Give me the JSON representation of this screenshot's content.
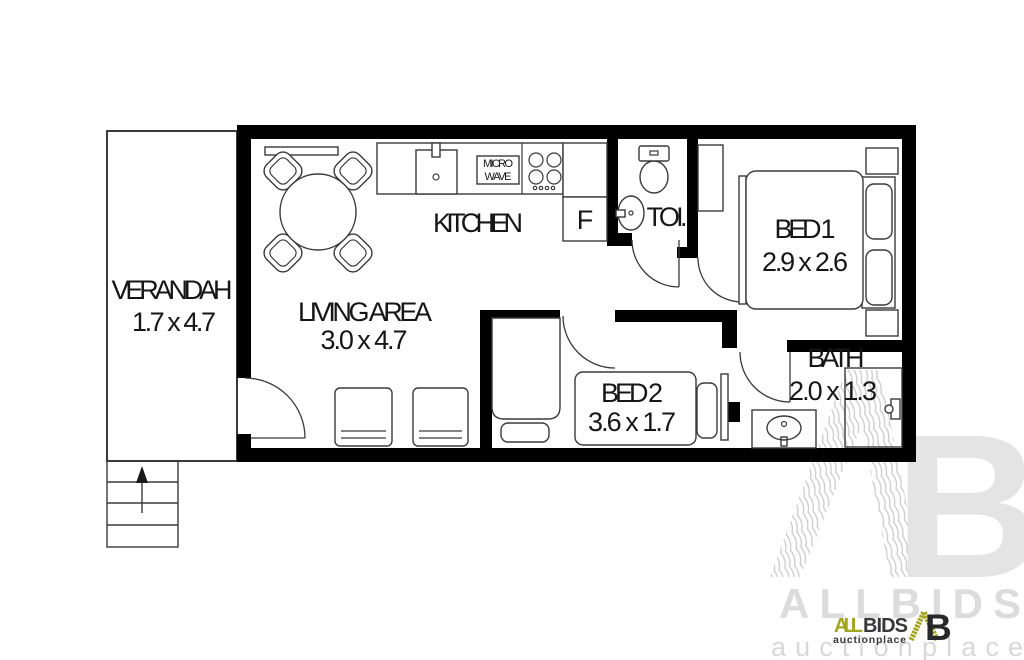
{
  "rooms": {
    "verandah": {
      "name": "VERANDAH",
      "dims": "1.7 x 4.7"
    },
    "living": {
      "name": "LIVING AREA",
      "dims": "3.0 x 4.7"
    },
    "kitchen": {
      "name": "KITCHEN"
    },
    "toilet": {
      "name": "TOI."
    },
    "bed1": {
      "name": "BED 1",
      "dims": "2.9 x 2.6"
    },
    "bed2": {
      "name": "BED 2",
      "dims": "3.6 x 1.7"
    },
    "bath": {
      "name": "BATH",
      "dims": "2.0 x 1.3"
    }
  },
  "appliances": {
    "fridge": "F",
    "microwave_line1": "MICRO",
    "microwave_line2": "WAVE"
  },
  "logo": {
    "brand_all": "ALL",
    "brand_bids": "BIDS",
    "tagline": "auctionplace",
    "monogram_b": "B"
  },
  "watermark": {
    "brand": "ALLBIDS",
    "tagline": "auctionplace",
    "monogram_b": "B"
  },
  "colors": {
    "accent_olive": "#a2a41e",
    "logo_dark": "#38383a",
    "wall_black": "#000000",
    "watermark_gray": "#dcdcdc",
    "watermark_light": "#e4e4e4"
  }
}
